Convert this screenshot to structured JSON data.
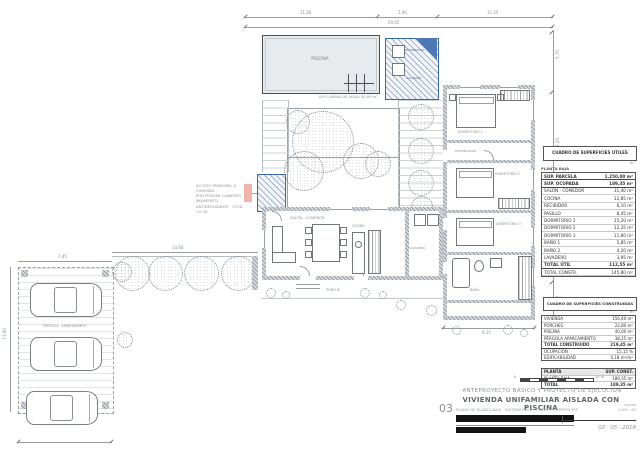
{
  "colors": {
    "accent_blue": "#3b66a8",
    "pool_fill": "#e8ebee",
    "pink_highlight": "#f0b4ae",
    "wall_gray": "#848a90",
    "line_gray": "#989da2"
  },
  "site": {
    "pool_label": "PISCINA",
    "pool_area_note": "SUP. LÁMINA DE AGUA: 40,00 m²",
    "solarium_label": "SOLARIUM",
    "equipment_label": "DEPURADORA",
    "living_label": "SALÓN - COMEDOR",
    "kitchen_label": "COCINA",
    "laundry_label": "LAVADERO",
    "porch_label": "PORCHE",
    "hall_label": "DISTRIBUIDOR",
    "bedroom1_label": "DORMITORIO 1",
    "bedroom2_label": "DORMITORIO 2",
    "bedroom3_label": "DORMITORIO 3",
    "bath_label": "BAÑO",
    "parking_label": "PÉRGOLA · APARCAMIENTO",
    "entry_note_line1": "ACCESO PRINCIPAL A VIVIENDA",
    "entry_note_line2": "POR PORCHE CUBIERTO",
    "entry_note_line3": "PAVIMENTO ANTIDESLIZANTE · COTA +0,45"
  },
  "dimensions": {
    "top_left": "11,60",
    "top_mid": "5,90",
    "top_right": "11,55",
    "top_total": "29,05",
    "right_1": "5,70",
    "right_2": "12,20",
    "right_3": "7,30",
    "right_4": "4,20",
    "wing_bottom": "9,15",
    "path_width": "14,60",
    "parking_width": "7,45",
    "parking_height": "13,90"
  },
  "tables": {
    "useful": {
      "title": "CUADRO DE SUPERFICIES ÚTILES",
      "unit": "m²",
      "floor_label": "PLANTA BAJA",
      "rows": [
        {
          "name": "SUP. PARCELA",
          "value": "1.250,00 m²"
        },
        {
          "name": "SUP. OCUPADA",
          "value": "189,35 m²"
        },
        {
          "name": "SALÓN - COMEDOR",
          "value": "31,40 m²"
        },
        {
          "name": "COCINA",
          "value": "12,85 m²"
        },
        {
          "name": "RECIBIDOR",
          "value": "6,10 m²"
        },
        {
          "name": "PASILLO",
          "value": "8,45 m²"
        },
        {
          "name": "DORMITORIO 1",
          "value": "15,20 m²"
        },
        {
          "name": "DORMITORIO 2",
          "value": "12,35 m²"
        },
        {
          "name": "DORMITORIO 3",
          "value": "11,60 m²"
        },
        {
          "name": "BAÑO 1",
          "value": "5,85 m²"
        },
        {
          "name": "BAÑO 2",
          "value": "4,20 m²"
        },
        {
          "name": "LAVADERO",
          "value": "3,95 m²"
        },
        {
          "name": "TOTAL ÚTIL",
          "value": "112,55 m²"
        },
        {
          "name": "TOTAL CONSTR.",
          "value": "145,80 m²"
        }
      ]
    },
    "built": {
      "title": "CUADRO DE SUPERFICIES CONSTRUIDAS",
      "unit": "m²",
      "rows": [
        {
          "name": "VIVIENDA",
          "value": "156,40 m²"
        },
        {
          "name": "PORCHES",
          "value": "22,80 m²"
        },
        {
          "name": "PISCINA",
          "value": "40,00 m²"
        },
        {
          "name": "PÉRGOLA APARCAMIENTO",
          "value": "38,25 m²"
        },
        {
          "name": "TOTAL CONSTRUIDO",
          "value": "219,45 m²"
        },
        {
          "name": "OCUPACIÓN",
          "value": "15,15 %"
        },
        {
          "name": "EDIFICABILIDAD",
          "value": "0,18 m²/m²"
        }
      ]
    },
    "summary": {
      "rows": [
        {
          "name": "PLANTA",
          "value": "SUP. CONST."
        },
        {
          "name": "PLANTA BAJA",
          "value": "189,35 m²"
        },
        {
          "name": "TOTAL",
          "value": "189,35 m²"
        }
      ]
    }
  },
  "title_block": {
    "phase": "ANTEPROYECTO BÁSICO Y PROYECTO DE EJECUCIÓN",
    "title": "VIVIENDA UNIFAMILIAR AISLADA CON PISCINA",
    "sheet_number": "03",
    "subtitle": "PLANO DE PLANTA BAJA · DISTRIBUCIÓN · COTAS Y SUPERFICIES",
    "scale_caption": "escala",
    "scale_value": "1/100 · A3",
    "scale_bar_zero": "0",
    "scale_bar_mid": "5",
    "scale_bar_end": "10 m",
    "date": "02 · 05 · 2016"
  }
}
